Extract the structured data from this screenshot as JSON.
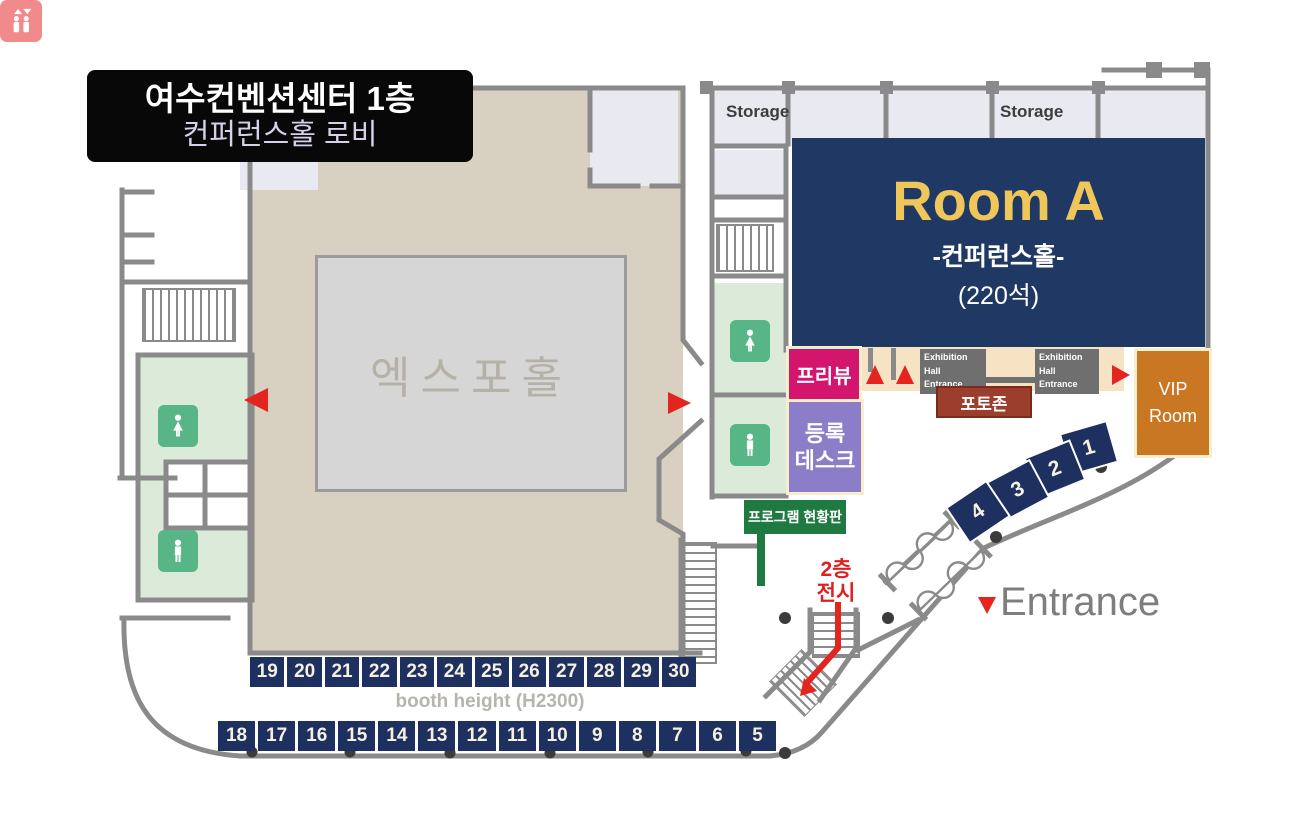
{
  "title": {
    "line1": "여수컨벤션센터 1층",
    "line2": "컨퍼런스홀 로비"
  },
  "expo_hall": {
    "label": "엑스포홀"
  },
  "room_a": {
    "name": "Room A",
    "subtitle": "-컨퍼런스홀-",
    "capacity": "(220석)"
  },
  "storage": {
    "left": "Storage",
    "right": "Storage"
  },
  "exhibition_entrance": {
    "line1": "Exhibition Hall",
    "line2": "Entrance"
  },
  "photo_zone": {
    "label": "포토존"
  },
  "vip_room": {
    "line1": "VIP",
    "line2": "Room"
  },
  "preview": {
    "label": "프리뷰"
  },
  "registration": {
    "line1": "등록",
    "line2": "데스크"
  },
  "program_board": {
    "label": "프로그램 현황판"
  },
  "second_floor_stairs": {
    "line1": "2층",
    "line2": "전시"
  },
  "entrance": {
    "label": "Entrance"
  },
  "booths": {
    "height_note": "booth height (H2300)",
    "diagonal": [
      "1",
      "2",
      "3",
      "4"
    ],
    "row_upper": [
      "19",
      "20",
      "21",
      "22",
      "23",
      "24",
      "25",
      "26",
      "27",
      "28",
      "29",
      "30"
    ],
    "row_lower": [
      "18",
      "17",
      "16",
      "15",
      "14",
      "13",
      "12",
      "11",
      "10",
      "9",
      "8",
      "7",
      "6",
      "5"
    ]
  },
  "icons": {
    "restrooms": [
      "woman-restroom",
      "man-restroom",
      "woman-restroom",
      "man-restroom"
    ],
    "elevator": "elevator",
    "arrows": "red-direction-arrows"
  },
  "colors": {
    "wall": "#8a8a8a",
    "room_a_navy": "#1f3864",
    "booth_navy": "#1e3060",
    "gold": "#eec65a",
    "preview_pink": "#d4156d",
    "registration_purple": "#8b7dc8",
    "vip_orange": "#c97722",
    "photo_brown": "#9c3e2e",
    "sign_green": "#1e7a41",
    "restroom_green": "#57b586",
    "room_green": "#dcead9",
    "beige": "#d8d0c1",
    "lavender": "#e9e9f2",
    "red": "#e3241f",
    "cream_border": "#f7eecb"
  }
}
